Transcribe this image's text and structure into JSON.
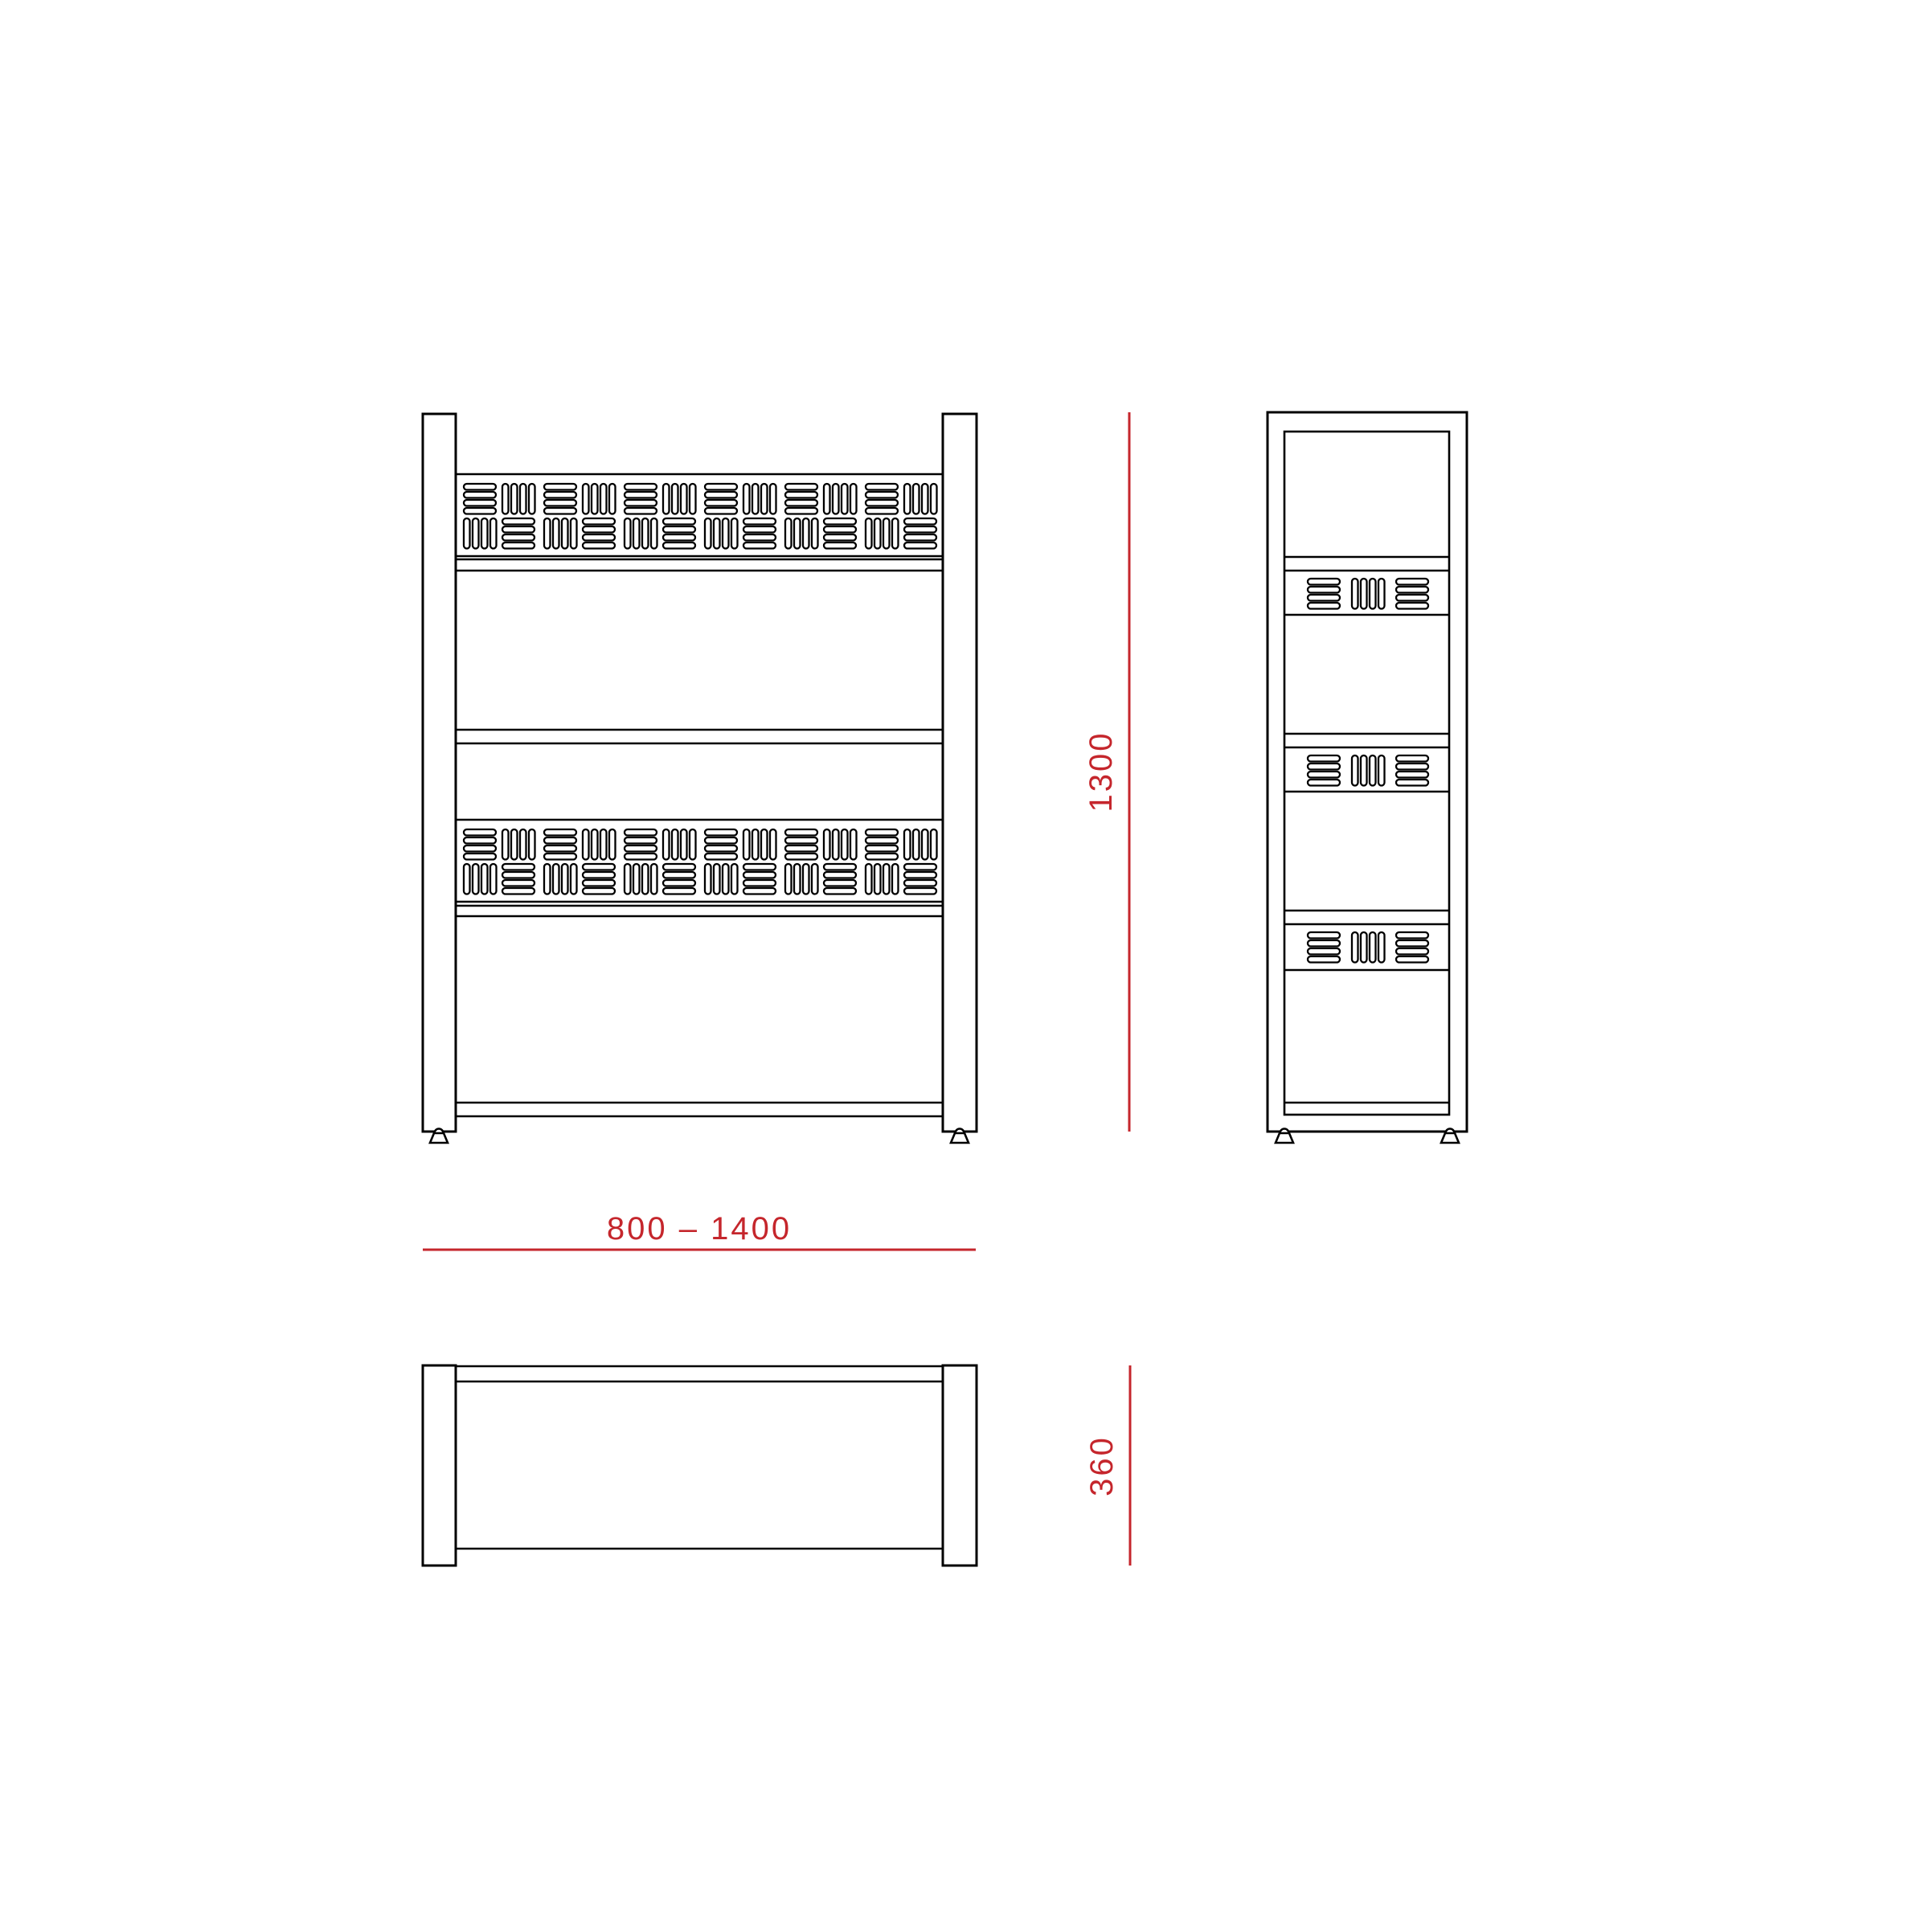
{
  "drawing": {
    "background": "#FFFFFF",
    "line_color": "#000000",
    "accent_color": "#C5262C"
  },
  "dimensions": {
    "width_label": "800 – 1400",
    "height_label": "1300",
    "depth_label": "360"
  }
}
